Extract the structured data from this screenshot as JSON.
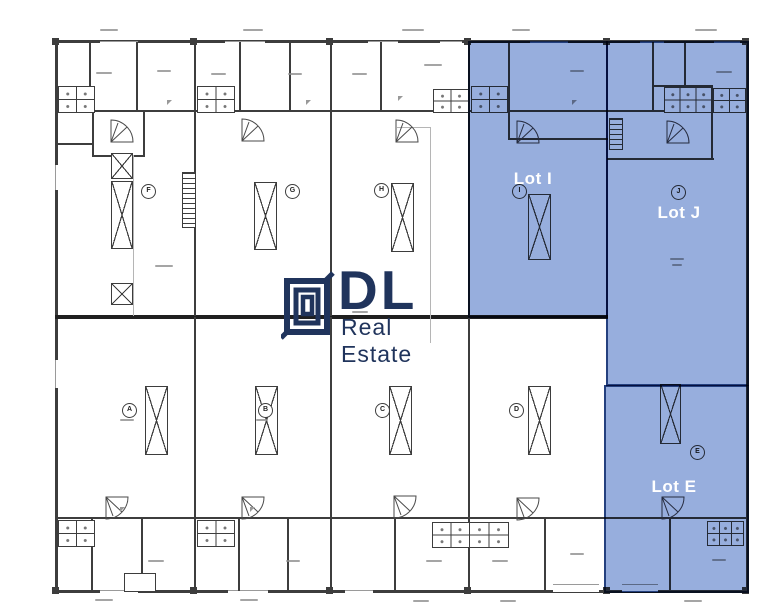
{
  "watermark": {
    "brand_initials": "DL",
    "brand_name": "Real Estate"
  },
  "lots": {
    "lot_i": {
      "label": "Lot I"
    },
    "lot_j": {
      "label": "Lot J"
    },
    "lot_e": {
      "label": "Lot E"
    }
  },
  "units": {
    "top_row": [
      {
        "letter": "F"
      },
      {
        "letter": "G"
      },
      {
        "letter": "H"
      },
      {
        "letter": "I"
      },
      {
        "letter": "J"
      }
    ],
    "bottom_row": [
      {
        "letter": "A"
      },
      {
        "letter": "B"
      },
      {
        "letter": "C"
      },
      {
        "letter": "D"
      },
      {
        "letter": "E"
      }
    ]
  },
  "colors": {
    "highlight_fill": "#97aedd",
    "highlight_wall": "#24407e",
    "wall": "#3d3d3d",
    "logo_navy": "#20345c",
    "lot_label_text": "#ffffff"
  }
}
